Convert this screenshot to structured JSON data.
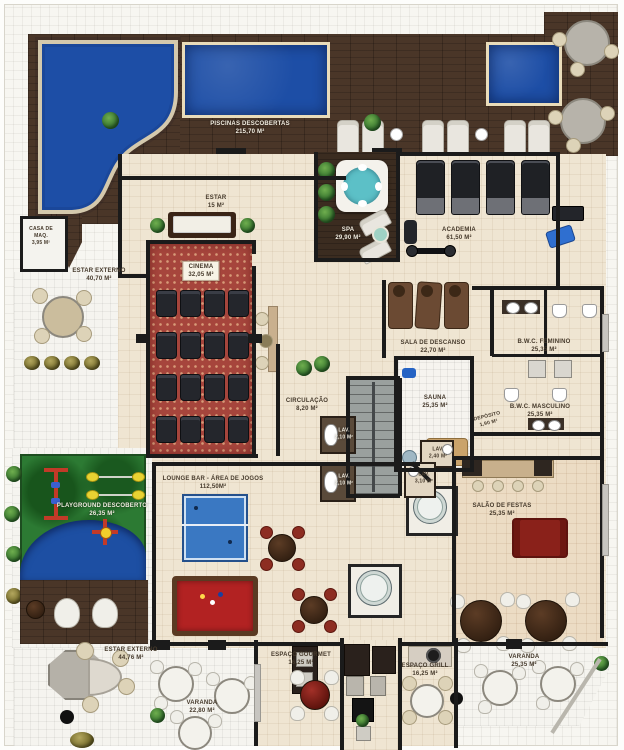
{
  "plan": {
    "title_note": "floor plan of condominium leisure level",
    "rooms": {
      "piscinas": {
        "name": "PISCINAS DESCOBERTAS",
        "area": "215,70 m²"
      },
      "casa_maq": {
        "name": "CASA DE MAQ.",
        "area": "3,95 m²"
      },
      "estar_externo_nw": {
        "name": "ESTAR EXTERNO",
        "area": "40,70 m²"
      },
      "estar": {
        "name": "ESTAR",
        "area": "15 m²"
      },
      "cinema": {
        "name": "CINEMA",
        "area": "32,05 m²"
      },
      "spa": {
        "name": "SPA",
        "area": "29,90 m²"
      },
      "academia": {
        "name": "ACADEMIA",
        "area": "61,50 m²"
      },
      "sala_descanso": {
        "name": "SALA DE DESCANSO",
        "area": "22,70 m²"
      },
      "bwc_feminino": {
        "name": "B.W.C. FEMININO",
        "area": "25,35 m²"
      },
      "sauna": {
        "name": "SAUNA",
        "area": "25,35 m²"
      },
      "deposito": {
        "name": "DEPÓSITO",
        "area": "1,90 m²"
      },
      "bwc_masculino": {
        "name": "B.W.C.  MASCULINO",
        "area": "25,35 m²"
      },
      "circulacao": {
        "name": "CIRCULAÇÃO",
        "area": "8,20 m²"
      },
      "lav_1": {
        "name": "LAV.",
        "area": "2,10 m²"
      },
      "lav_2": {
        "name": "LAV.",
        "area": "2,10 m²"
      },
      "lav_3": {
        "name": "LAV.",
        "area": "2,40 m²"
      },
      "lav_4": {
        "name": "LAV.",
        "area": "3,10 m²"
      },
      "lounge": {
        "name": "LOUNGE BAR - ÁREA DE JOGOS",
        "area": "112,50m²"
      },
      "playground": {
        "name": "PLAYGROUND DESCOBERTO",
        "area": "26,35 m²"
      },
      "salao_festas": {
        "name": "SALÃO DE FESTAS",
        "area": "25,35 m²"
      },
      "estar_externo_sw": {
        "name": "ESTAR EXTERNO",
        "area": "44,76 m²"
      },
      "varanda_sw": {
        "name": "VARANDA",
        "area": "22,80 m²"
      },
      "espaco_gourmet": {
        "name": "ESPAÇO GOURMET",
        "area": "16,25 m²"
      },
      "espaco_grill": {
        "name": "ESPAÇO GRILL",
        "area": "16,25 m²"
      },
      "varanda_se": {
        "name": "VARANDA",
        "area": "25,35 m²"
      }
    },
    "colors": {
      "pool": "#1d4ea6",
      "deck_wood": "#4a3628",
      "floor": "#efe5d2",
      "wall": "#1b1b1b",
      "cinema_carpet": "#a6453c",
      "grass": "#2c7a33",
      "billiard_felt": "#b22222",
      "pingpong": "#3a78c2",
      "sofa_red": "#8a211a",
      "jacuzzi_teal": "#5cc0c7"
    }
  }
}
